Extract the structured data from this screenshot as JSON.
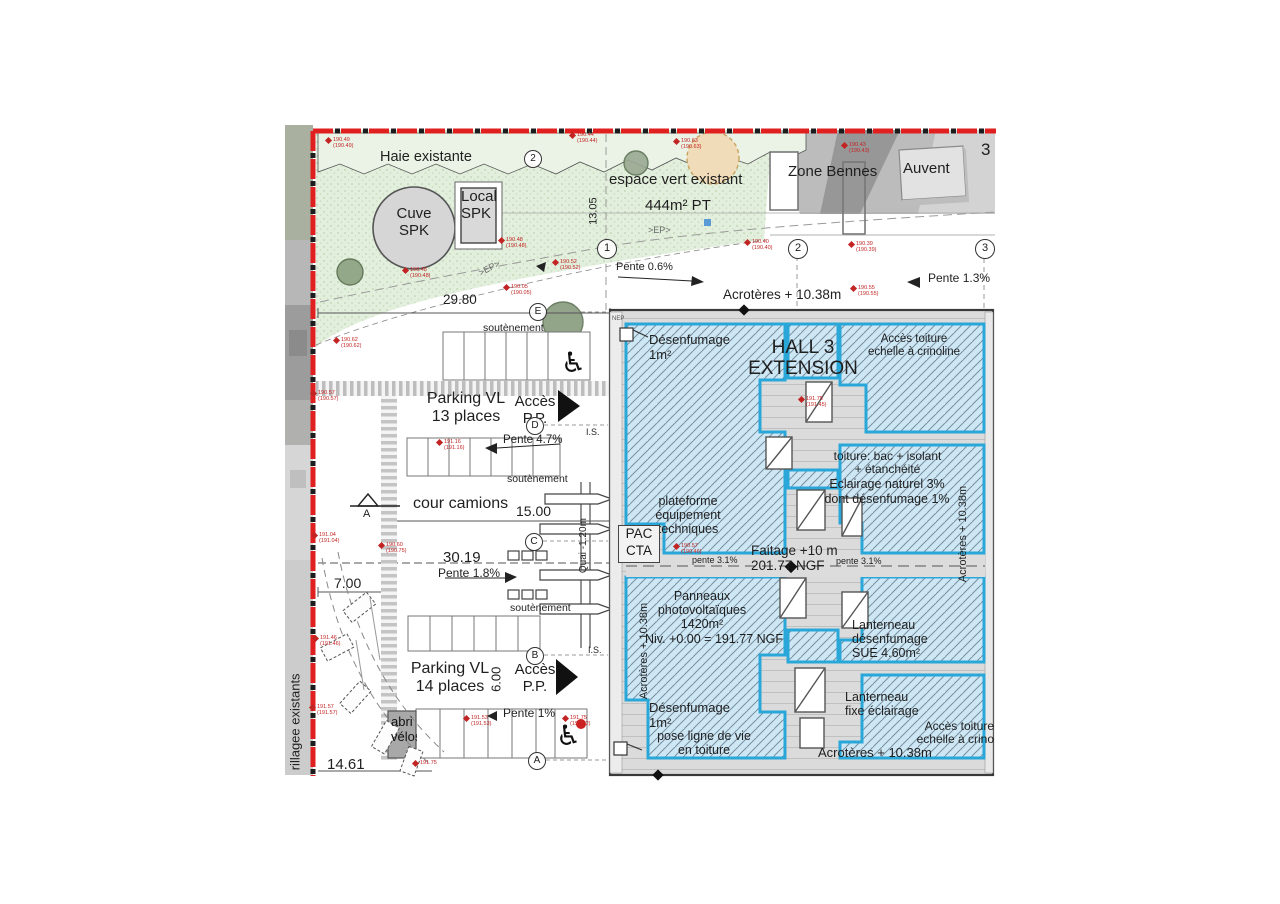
{
  "site": {
    "haie": "Haie existante",
    "espace_vert_1": "espace vert existant",
    "espace_vert_2": "444m² PT",
    "zone_bennes": "Zone Bennes",
    "auvent": "Auvent",
    "cuve_1": "Cuve",
    "cuve_2": "SPK",
    "local_1": "Local",
    "local_2": "SPK",
    "corner_number": "3",
    "ep": ">EP>",
    "nep": "NEP",
    "grillage_vertical": "rillagee existants"
  },
  "dims": {
    "d2980": "29.80",
    "d1305": "13.05",
    "d1500": "15.00",
    "d3019": "30.19",
    "d700": "7.00",
    "d600": "6.00",
    "d1461": "14.61",
    "quai": "Quai -1.20m"
  },
  "parking": {
    "p13a": "Parking VL",
    "p13b": "13 places",
    "p14a": "Parking VL",
    "p14b": "14 places",
    "acces": "Accès",
    "pp": "P.P.",
    "soutenement": "soutènement",
    "cour_camions": "cour camions",
    "abri_1": "abri",
    "abri_2": "vélos",
    "is": "I.S."
  },
  "slopes": {
    "s06": "Pente 0.6%",
    "s13": "Pente 1.3%",
    "s47": "Pente 4.7%",
    "s18": "Pente 1.8%",
    "s1": "Pente 1%",
    "s31": "pente 3.1%"
  },
  "grid": {
    "g1": "1",
    "g2": "2",
    "g3": "3",
    "gA": "A",
    "gB": "B",
    "gC": "C",
    "gD": "D",
    "gE": "E",
    "section": "A"
  },
  "hall": {
    "title_1": "HALL 3",
    "title_2": "EXTENSION",
    "desenfumage": "Désenfumage",
    "un_m2": "1m²",
    "acces_toiture": "Accès toiture",
    "crinoline": "echelle à crinoline",
    "crinoline_cut": "echelle à crino",
    "toiture_1": "toiture: bac + isolant",
    "toiture_2": "+ étanchéité",
    "eclairage": "Eclairage naturel 3%",
    "dont": "dont désenfumage 1%",
    "plateforme_1": "plateforme",
    "plateforme_2": "équipement",
    "plateforme_3": "techniques",
    "pac": "PAC",
    "cta": "CTA",
    "faitage_1": "Faitage +10 m",
    "faitage_2": "201.77 NGF",
    "panneaux_1": "Panneaux",
    "panneaux_2": "photovoltaïques",
    "panneaux_3": "1420m²",
    "niv": "Niv. +0.00 = 191.77 NGF",
    "acroteres": "Acrotères + 10.38m",
    "lanterneau_1a": "Lanterneau",
    "lanterneau_1b": "désenfumage",
    "lanterneau_1c": "SUE 4.60m²",
    "lanterneau_2a": "Lanterneau",
    "lanterneau_2b": "fixe éclairage",
    "pose_1": "pose ligne de vie",
    "pose_2": "en toiture"
  },
  "markers": [
    {
      "x": 333,
      "y": 137,
      "v": "190.49",
      "v2": "(190.49)"
    },
    {
      "x": 577,
      "y": 132,
      "v": "190.44",
      "v2": "(190.44)"
    },
    {
      "x": 681,
      "y": 138,
      "v": "190.63",
      "v2": "(190.63)"
    },
    {
      "x": 849,
      "y": 142,
      "v": "190.43",
      "v2": "(190.43)"
    },
    {
      "x": 506,
      "y": 237,
      "v": "190.48",
      "v2": "(190.48)"
    },
    {
      "x": 410,
      "y": 267,
      "v": "190.48",
      "v2": "(190.48)"
    },
    {
      "x": 511,
      "y": 284,
      "v": "190.05",
      "v2": "(190.05)"
    },
    {
      "x": 560,
      "y": 259,
      "v": "190.52",
      "v2": "(190.52)"
    },
    {
      "x": 752,
      "y": 239,
      "v": "190.40",
      "v2": "(190.40)"
    },
    {
      "x": 856,
      "y": 241,
      "v": "190.39",
      "v2": "(190.39)"
    },
    {
      "x": 858,
      "y": 285,
      "v": "190.55",
      "v2": "(190.55)"
    },
    {
      "x": 341,
      "y": 337,
      "v": "190.62",
      "v2": "(190.62)"
    },
    {
      "x": 318,
      "y": 390,
      "v": "190.57",
      "v2": "(190.57)"
    },
    {
      "x": 444,
      "y": 439,
      "v": "191.16",
      "v2": "(191.16)"
    },
    {
      "x": 806,
      "y": 396,
      "v": "191.75",
      "v2": "(191.45)"
    },
    {
      "x": 319,
      "y": 532,
      "v": "191.04",
      "v2": "(191.04)"
    },
    {
      "x": 386,
      "y": 542,
      "v": "190.60",
      "v2": "(190.75)"
    },
    {
      "x": 681,
      "y": 543,
      "v": "190.57",
      "v2": "(190.46)"
    },
    {
      "x": 320,
      "y": 635,
      "v": "191.46",
      "v2": "(191.46)"
    },
    {
      "x": 317,
      "y": 704,
      "v": "191.57",
      "v2": "(191.57)"
    },
    {
      "x": 471,
      "y": 715,
      "v": "191.53",
      "v2": "(191.53)"
    },
    {
      "x": 570,
      "y": 715,
      "v": "191.75",
      "v2": "(191.72)"
    },
    {
      "x": 420,
      "y": 760,
      "v": "191.75",
      "v2": ""
    }
  ]
}
